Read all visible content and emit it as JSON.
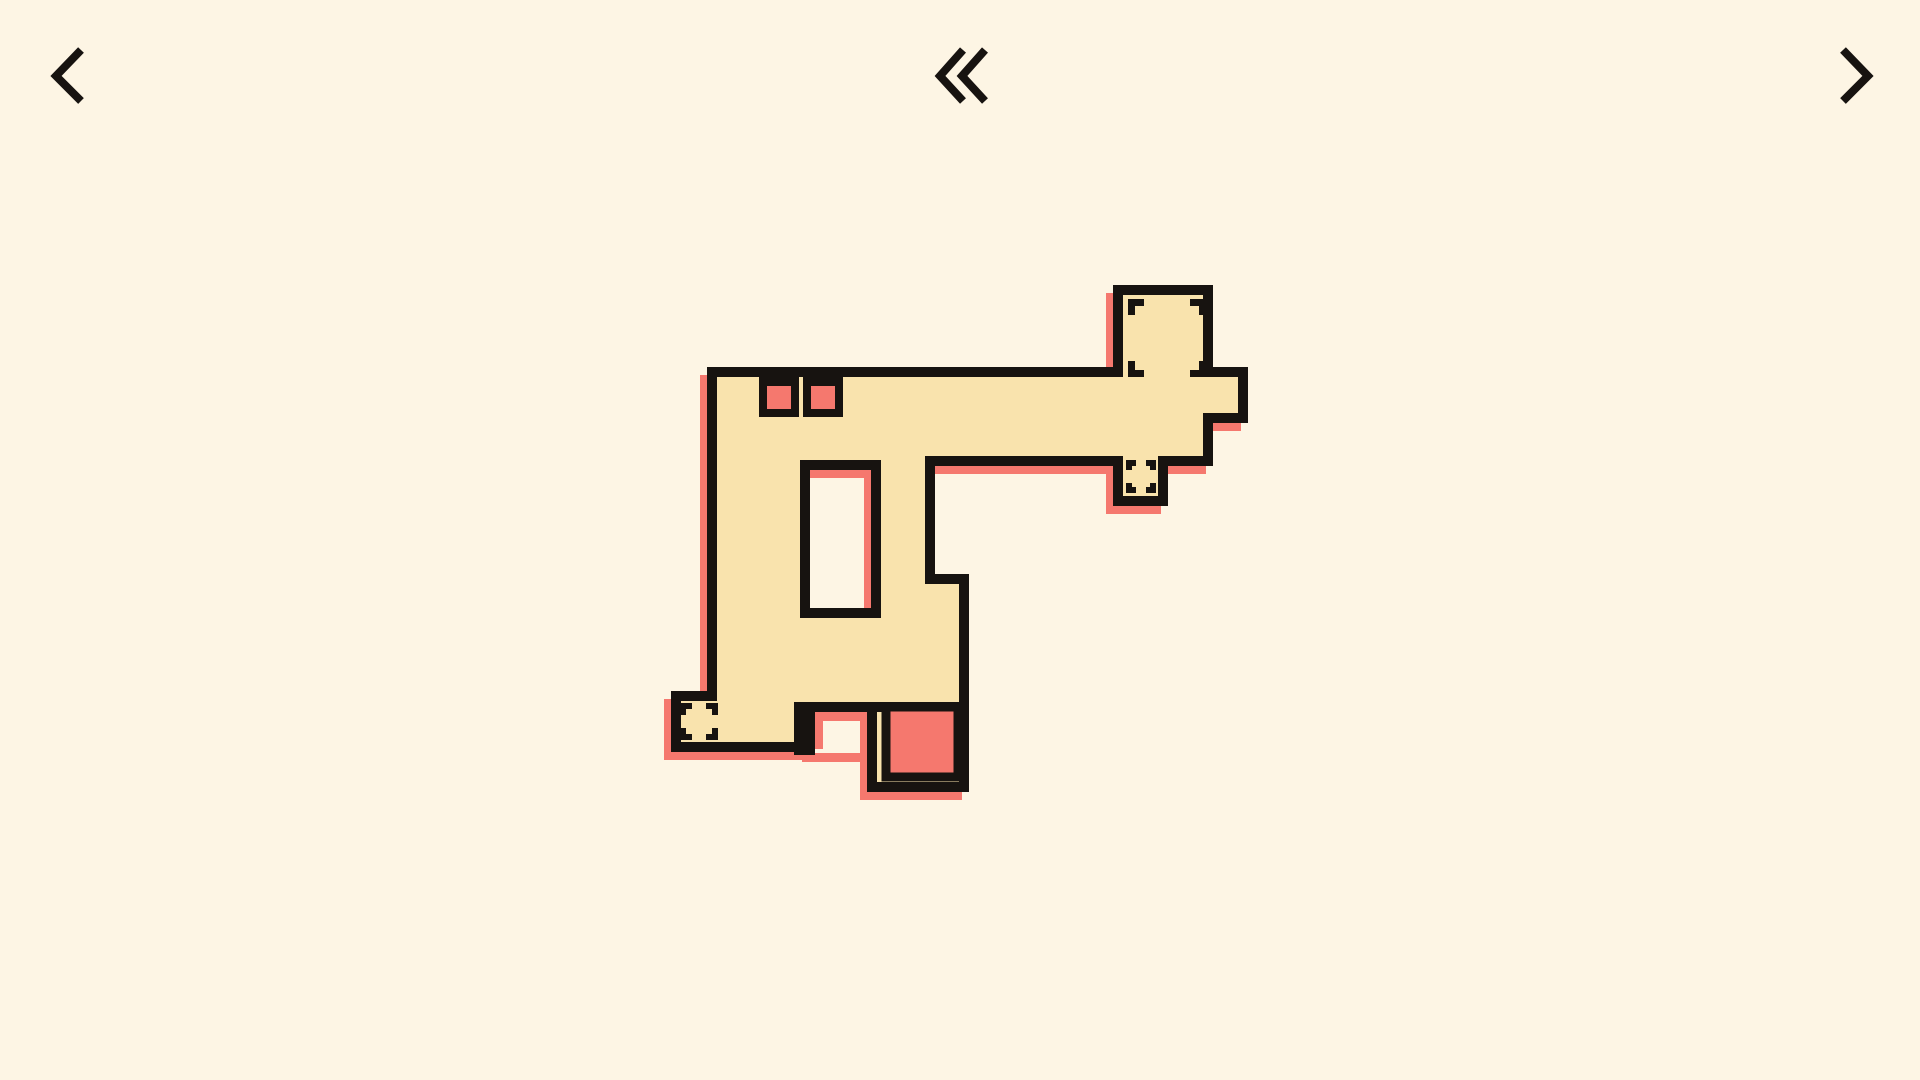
{
  "app": {
    "title": "puzzle-level",
    "type": "tile-puzzle-game"
  },
  "colors": {
    "background": "#FDF5E4",
    "piece": "#F9E3AD",
    "accent": "#F5786E",
    "outline": "#171310"
  },
  "nav": {
    "stroke_width": 8,
    "prev": {
      "name": "previous-level",
      "chevrons": [
        [
          [
            81,
            50
          ],
          [
            56,
            76
          ],
          [
            81,
            101
          ]
        ]
      ]
    },
    "rewind": {
      "name": "back-to-levels",
      "chevrons": [
        [
          [
            963,
            50
          ],
          [
            940,
            76
          ],
          [
            963,
            101
          ]
        ],
        [
          [
            985,
            50
          ],
          [
            962,
            76
          ],
          [
            985,
            101
          ]
        ]
      ]
    },
    "next": {
      "name": "next-level",
      "chevrons": [
        [
          [
            1843,
            50
          ],
          [
            1868,
            76
          ],
          [
            1843,
            101
          ]
        ]
      ]
    }
  },
  "board": {
    "outline_stroke": 10,
    "shadow_offset": {
      "dx": -7,
      "dy": 8
    },
    "piece_outline": [
      [
        712,
        372
      ],
      [
        1118,
        372
      ],
      [
        1118,
        290
      ],
      [
        1208,
        290
      ],
      [
        1208,
        372
      ],
      [
        1243,
        372
      ],
      [
        1243,
        418
      ],
      [
        1208,
        418
      ],
      [
        1208,
        461
      ],
      [
        1163,
        461
      ],
      [
        1163,
        501
      ],
      [
        1118,
        501
      ],
      [
        1118,
        461
      ],
      [
        930,
        461
      ],
      [
        930,
        579
      ],
      [
        964,
        579
      ],
      [
        964,
        787
      ],
      [
        872,
        787
      ],
      [
        872,
        707
      ],
      [
        809,
        707
      ],
      [
        809,
        747
      ],
      [
        676,
        747
      ],
      [
        676,
        696
      ],
      [
        712,
        696
      ]
    ],
    "window_hole": {
      "x": 805,
      "y": 465,
      "w": 71,
      "h": 148
    },
    "interior_lines": [
      {
        "x": 867,
        "y": 702,
        "w": 102,
        "h": 10
      },
      {
        "x": 794,
        "y": 702,
        "w": 21,
        "h": 53
      }
    ],
    "shadow_patches": [
      {
        "x": 815,
        "y": 712,
        "w": 53,
        "h": 9
      },
      {
        "x": 815,
        "y": 712,
        "w": 8,
        "h": 37
      },
      {
        "x": 802,
        "y": 753,
        "w": 66,
        "h": 9
      }
    ],
    "small_crates": [
      {
        "name": "crate-small-1",
        "frame": {
          "x": 759,
          "y": 370,
          "w": 40,
          "h": 47
        },
        "fill": {
          "x": 767,
          "y": 386,
          "w": 24,
          "h": 23
        }
      },
      {
        "name": "crate-small-2",
        "frame": {
          "x": 803,
          "y": 370,
          "w": 40,
          "h": 47
        },
        "fill": {
          "x": 811,
          "y": 386,
          "w": 24,
          "h": 23
        }
      }
    ],
    "large_crate": {
      "name": "crate-large",
      "x": 886,
      "y": 707,
      "w": 72,
      "h": 70,
      "stroke": 9
    },
    "targets": [
      {
        "name": "socket-tower",
        "x": 1128,
        "y": 299,
        "w": 78,
        "h": 78,
        "arm": 16,
        "t": 7
      },
      {
        "name": "socket-stub",
        "x": 1126,
        "y": 460,
        "w": 30,
        "h": 33,
        "arm": 10,
        "t": 6
      },
      {
        "name": "socket-foot",
        "x": 680,
        "y": 703,
        "w": 38,
        "h": 37,
        "arm": 12,
        "t": 6
      }
    ]
  }
}
